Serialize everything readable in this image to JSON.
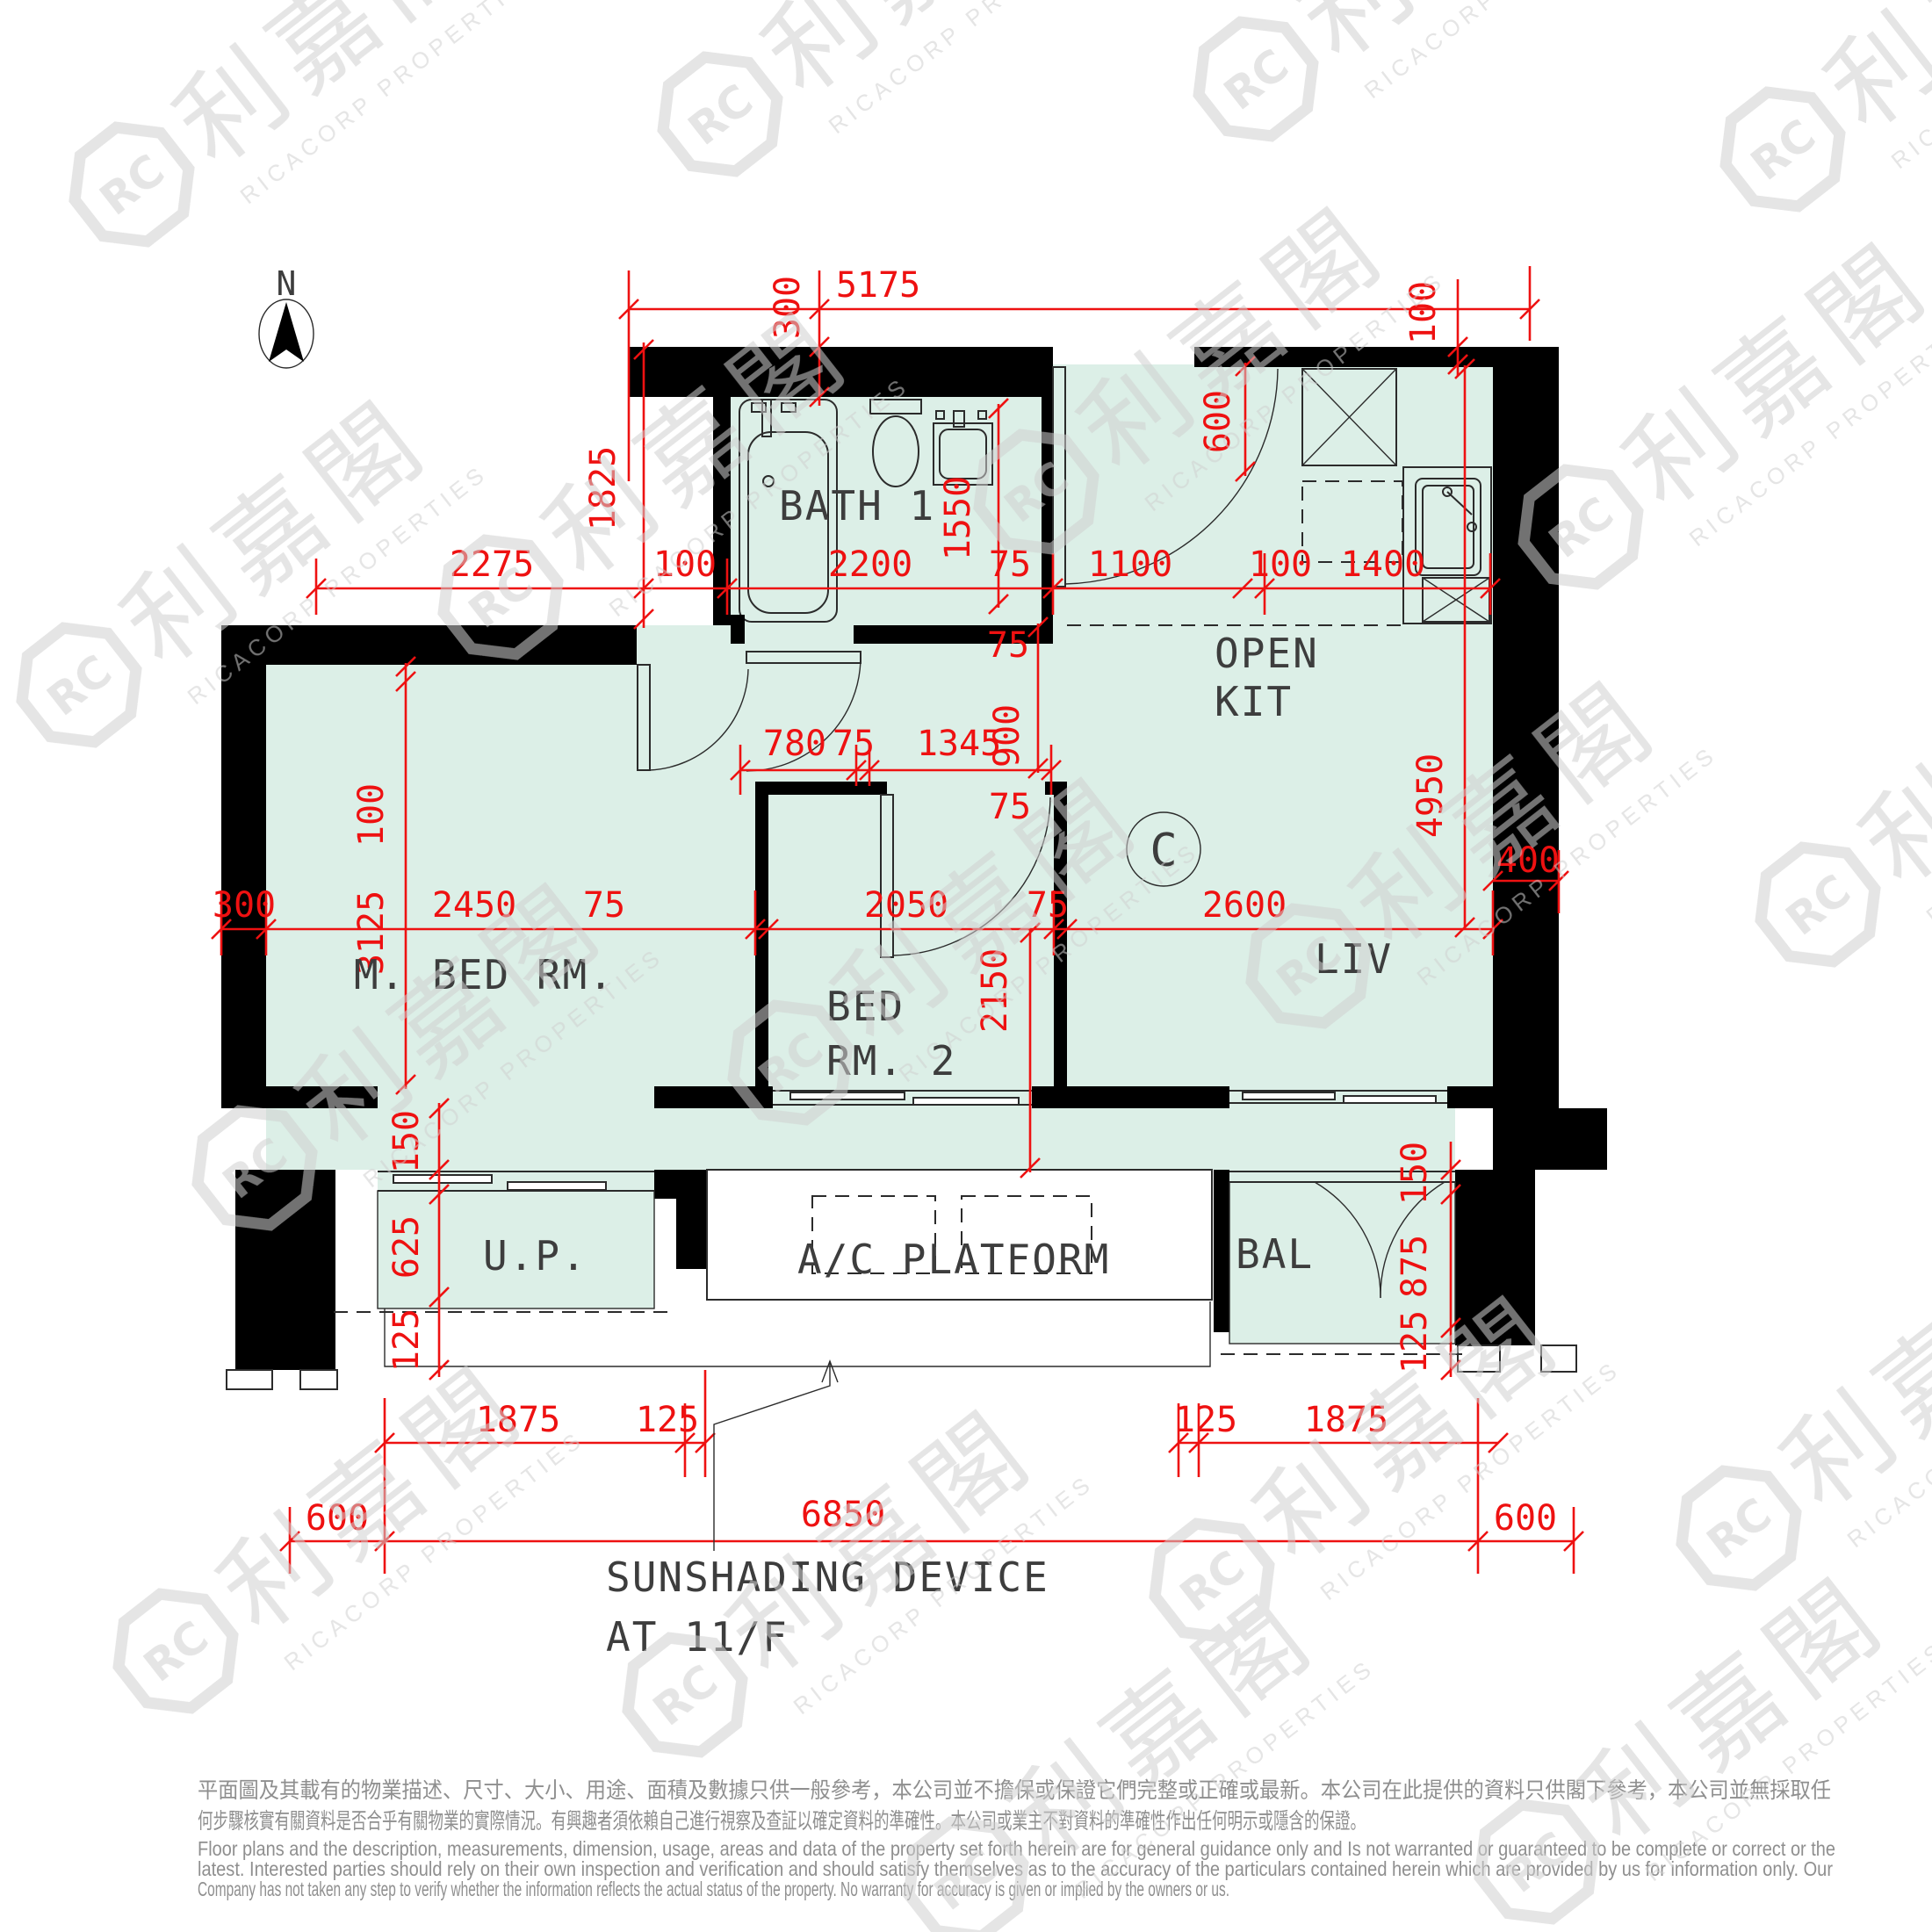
{
  "compass": {
    "north_label": "N"
  },
  "unit": {
    "label": "C"
  },
  "rooms": {
    "bath1": "BATH 1",
    "kit_line1": "OPEN",
    "kit_line2": "KIT",
    "master_bedroom": "M. BED RM.",
    "bedroom2_line1": "BED",
    "bedroom2_line2": "RM. 2",
    "living": "LIV",
    "utility": "U.P.",
    "ac_platform": "A/C PLATFORM",
    "balcony": "BAL"
  },
  "annotations": {
    "sunshade_line1": "SUNSHADING DEVICE",
    "sunshade_line2": "AT 11/F"
  },
  "dims": {
    "top_5175": "5175",
    "top_300": "300",
    "top_100": "100",
    "r2_2275": "2275",
    "r2_100a": "100",
    "r2_2200": "2200",
    "r2_75": "75",
    "r2_1100": "1100",
    "r2_100b": "100",
    "r2_1400": "1400",
    "r3_780": "780",
    "r3_75": "75",
    "r3_1345": "1345",
    "m_300": "300",
    "m_2450": "2450",
    "m_75a": "75",
    "m_2050": "2050",
    "m_75b": "75",
    "m_2600": "2600",
    "m_400": "400",
    "v_1825": "1825",
    "v_1550": "1550",
    "v_600": "600",
    "v_900": "900",
    "v_75a": "75",
    "v_75b": "75",
    "v_4950": "4950",
    "v_100": "100",
    "v_3125": "3125",
    "v_2150": "2150",
    "up_150": "150",
    "up_625": "625",
    "up_125": "125",
    "bal_150": "150",
    "bal_875": "875",
    "bal_125": "125",
    "b_1875l": "1875",
    "b_125l": "125",
    "b_125r": "125",
    "b_1875r": "1875",
    "b_600l": "600",
    "b_6850": "6850",
    "b_600r": "600"
  },
  "watermark": {
    "cjk": "利嘉閣",
    "latin": "RICACORP PROPERTIES",
    "monogram": "RC"
  },
  "disclaimer": {
    "zh1": "平面圖及其載有的物業描述、尺寸、大小、用途、面積及數據只供一般參考，本公司並不擔保或保證它們完整或正確或最新。本公司在此提供的資料只供閣下參考，本公司並無採取任",
    "zh2": "何步驟核實有關資料是否合乎有關物業的實際情況。有興趣者須依賴自己進行視察及查証以確定資料的準確性。本公司或業主不對資料的準確性作出任何明示或隱含的保證。",
    "en1": "Floor plans and the description, measurements, dimension, usage, areas and data of the property set forth herein are for general guidance only and Is not warranted or guaranteed to be complete or correct or the",
    "en2": "latest. Interested parties should rely on their own inspection and verification and should satisfy themselves as to the accuracy of the particulars contained herein which are provided by us for information only.  Our",
    "en3": "Company has not taken any step to verify whether the information reflects the actual status of the property.  No warranty for accuracy is given or implied by the owners or us."
  },
  "colors": {
    "floor": "#dcefe7",
    "wall": "#000000",
    "dim": "#ee1111",
    "line": "#2b2b2b",
    "text": "#3d3d3d",
    "muted": "#8f8f8f",
    "watermark": "#cfcfcf"
  }
}
